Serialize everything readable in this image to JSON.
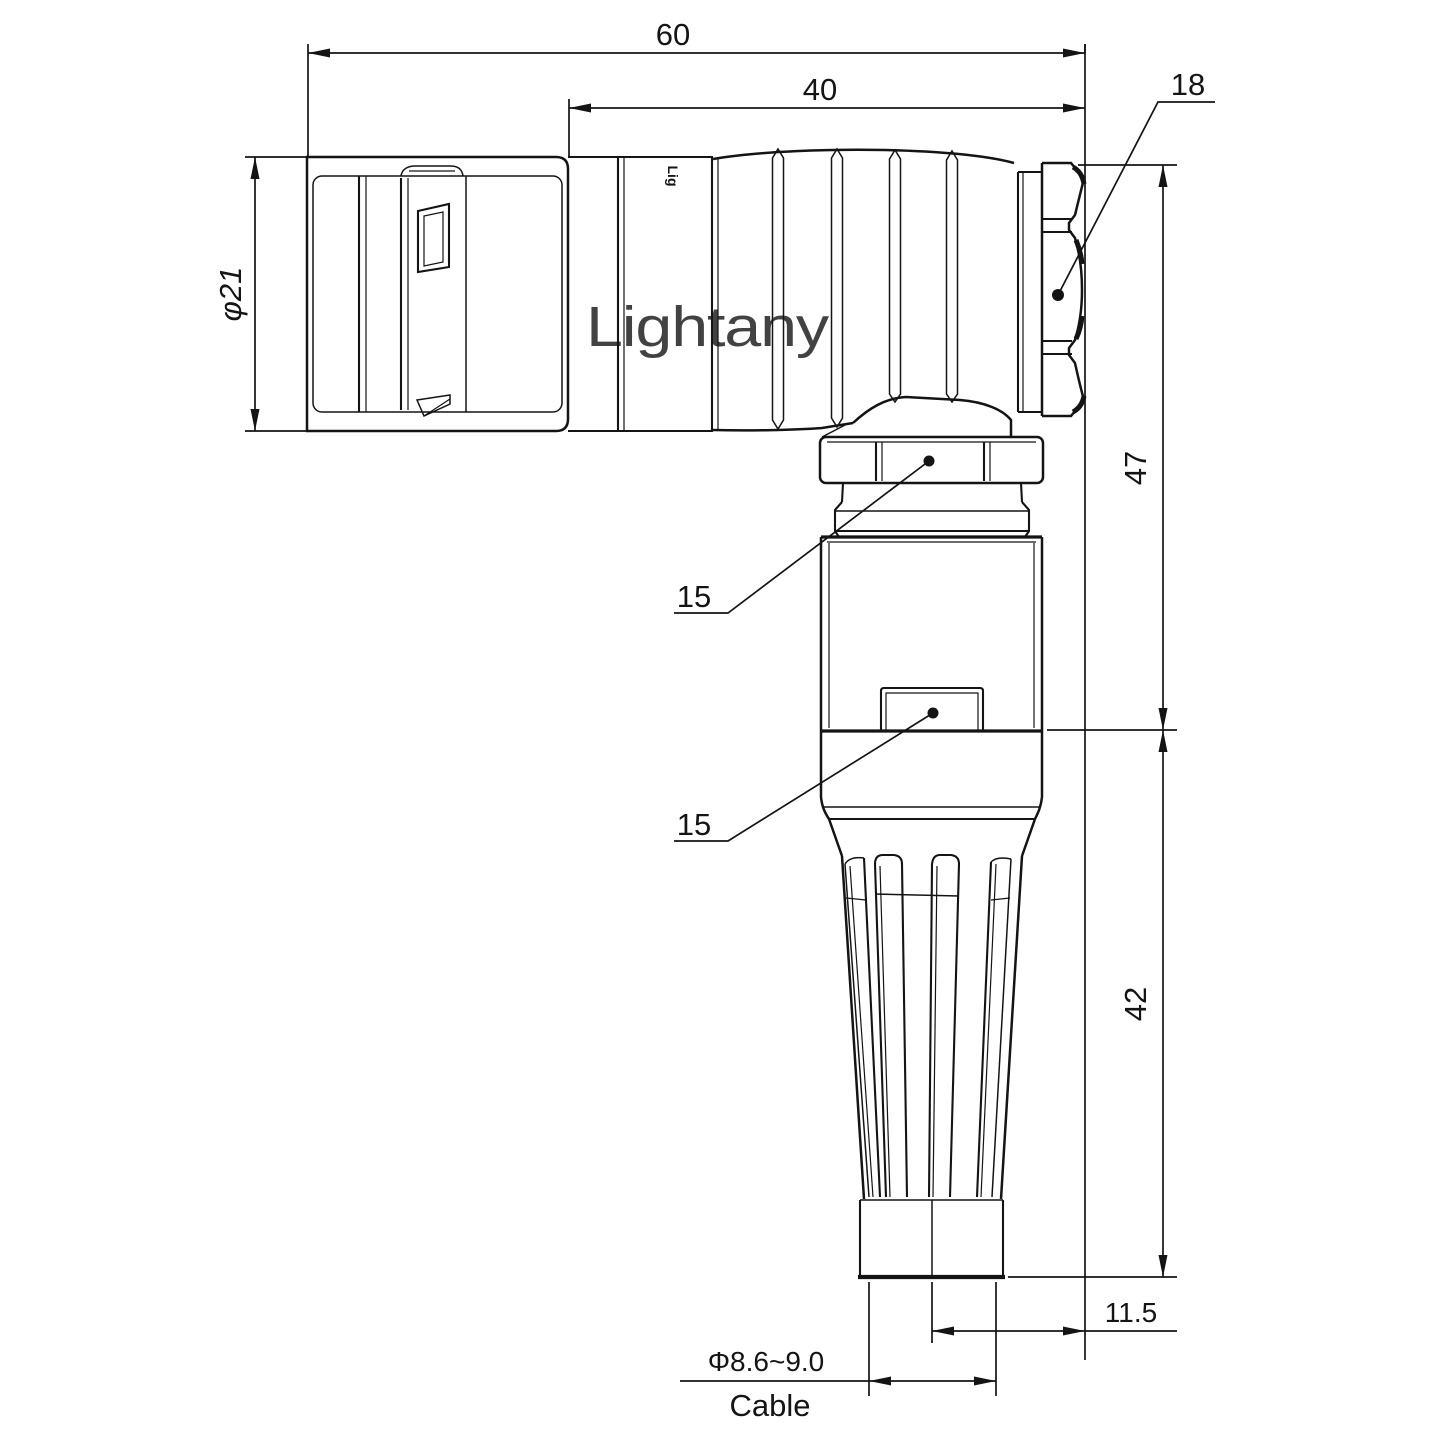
{
  "drawing": {
    "type": "technical-dimension-drawing",
    "subject": "right-angle circular push-pull connector, side view",
    "background_color": "#ffffff",
    "line_color": "#141414",
    "watermark": {
      "text": "Lightany",
      "color": "#f3c8c5"
    },
    "body_logo": {
      "text": "Lig"
    },
    "dims": {
      "overall_length": "60",
      "sleeve_length": "40",
      "front_diameter": "φ21",
      "upper_height": "47",
      "lower_height": "42",
      "cable_offset": "11.5",
      "cable_diameter": "Φ8.6~9.0",
      "cable_caption": "Cable",
      "nut_across_flats": "18",
      "wrench_flat_upper": "15",
      "wrench_flat_lower": "15"
    },
    "dimension_values": {
      "overall_length_mm": 60,
      "sleeve_length_mm": 40,
      "front_diameter_mm": 21,
      "upper_height_mm": 47,
      "lower_height_mm": 42,
      "cable_offset_mm": 11.5,
      "cable_diameter_mm_min": 8.6,
      "cable_diameter_mm_max": 9.0,
      "nut_across_flats_mm": 18,
      "wrench_flat_mm": 15
    }
  }
}
